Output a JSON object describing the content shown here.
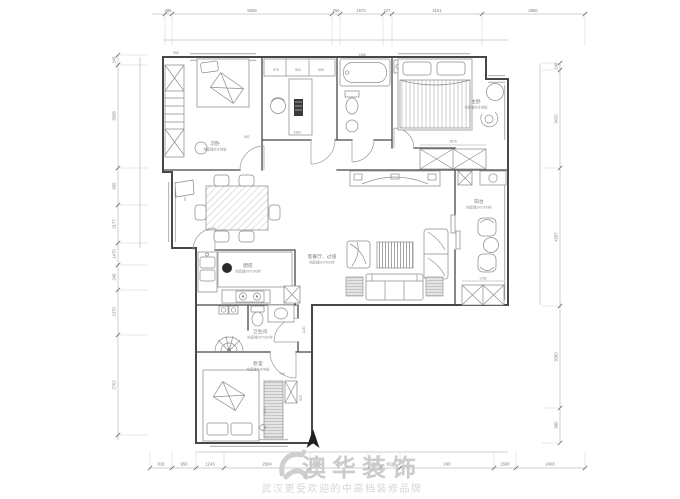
{
  "watermark": {
    "brand": "澳华装饰",
    "slogan": "武汉更受欢迎的中高档装修品牌"
  },
  "rooms": [
    {
      "name": "次卧",
      "note": "地面铺实木地板"
    },
    {
      "name": "主卧",
      "note": "地面铺实木地板"
    },
    {
      "name": "阳台",
      "note": "地面铺300*300砖"
    },
    {
      "name": "客餐厅、过道",
      "note": "地面铺800*800砖"
    },
    {
      "name": "厨房",
      "note": "地面铺300*300砖"
    },
    {
      "name": "卫生间",
      "note": "地面铺300*300砖"
    },
    {
      "name": "卧室",
      "note": "地面铺实木地板"
    }
  ],
  "dims": {
    "top": [
      "285",
      "5508",
      "250",
      "1572",
      "227",
      "2181",
      "2850"
    ],
    "bottom": [
      "818",
      "950",
      "1243",
      "2904",
      "226",
      "296",
      "912",
      "240",
      "1590",
      "2408"
    ],
    "left": [
      "245",
      "3308",
      "805",
      "2177",
      "1470",
      "249",
      "1370",
      "2762"
    ],
    "right": [
      "240",
      "3420",
      "4297",
      "3280",
      "990"
    ],
    "inner": [
      "555",
      "852",
      "878",
      "550",
      "655",
      "2364",
      "1368",
      "1876",
      "1782",
      "706",
      "925",
      "1963",
      "1140"
    ]
  },
  "colors": {
    "wall": "#474747",
    "furniture": "#8e8e8e",
    "dimension": "#7d7d7d",
    "watermark": "#cbcbcb",
    "north_arrow": "#1f1f1f"
  }
}
